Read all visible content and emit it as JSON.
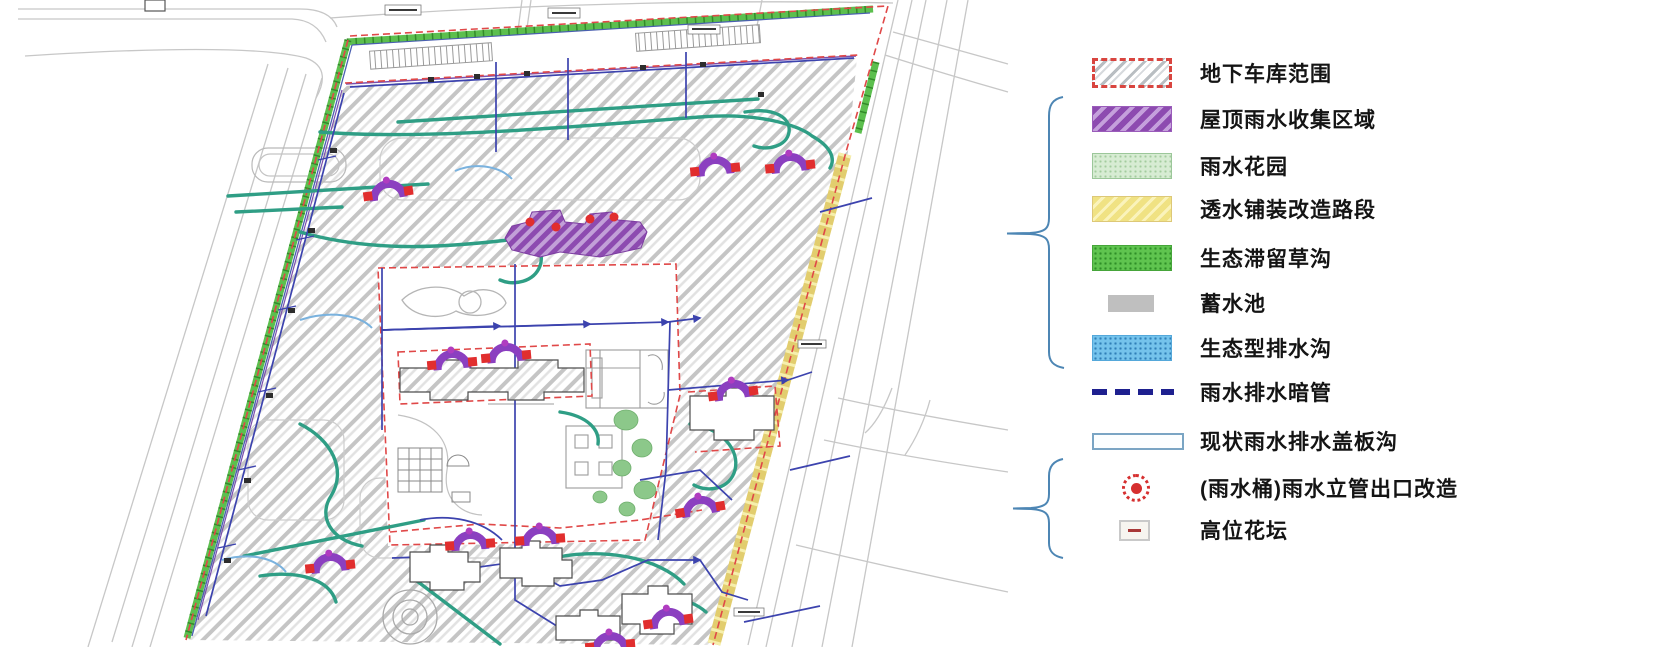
{
  "legend": {
    "items": [
      {
        "label": "地下车库范围",
        "swatch": "garage-range"
      },
      {
        "label": "屋顶雨水收集区域",
        "swatch": "roof-rainwater-collection"
      },
      {
        "label": "雨水花园",
        "swatch": "rain-garden"
      },
      {
        "label": "透水铺装改造路段",
        "swatch": "permeable-paving-retrofit"
      },
      {
        "label": "生态滞留草沟",
        "swatch": "bio-retention-grass-swale"
      },
      {
        "label": "蓄水池",
        "swatch": "storage-reservoir"
      },
      {
        "label": "生态型排水沟",
        "swatch": "ecological-drainage-ditch"
      },
      {
        "label": "雨水排水暗管",
        "swatch": "buried-storm-drain-pipe"
      },
      {
        "label": "现状雨水排水盖板沟",
        "swatch": "existing-covered-drain-channel"
      },
      {
        "label": "(雨水桶)雨水立管出口改造",
        "swatch": "rain-barrel-downpipe-outlet-retrofit"
      },
      {
        "label": "高位花坛",
        "swatch": "raised-planter"
      }
    ],
    "colors": {
      "garage_border": "#d9453f",
      "roof_purple": "#8d4bb0",
      "rain_garden_green": "#d7ecd3",
      "permeable_yellow": "#f0e283",
      "swale_green": "#5fc44f",
      "reservoir_gray": "#bfbfbf",
      "eco_ditch_blue": "#74c3ec",
      "pipe_navy": "#1e208f",
      "cover_ditch_border": "#7aa5c4",
      "barrel_red": "#d62f2f",
      "brace_blue": "#4d86b4"
    }
  }
}
